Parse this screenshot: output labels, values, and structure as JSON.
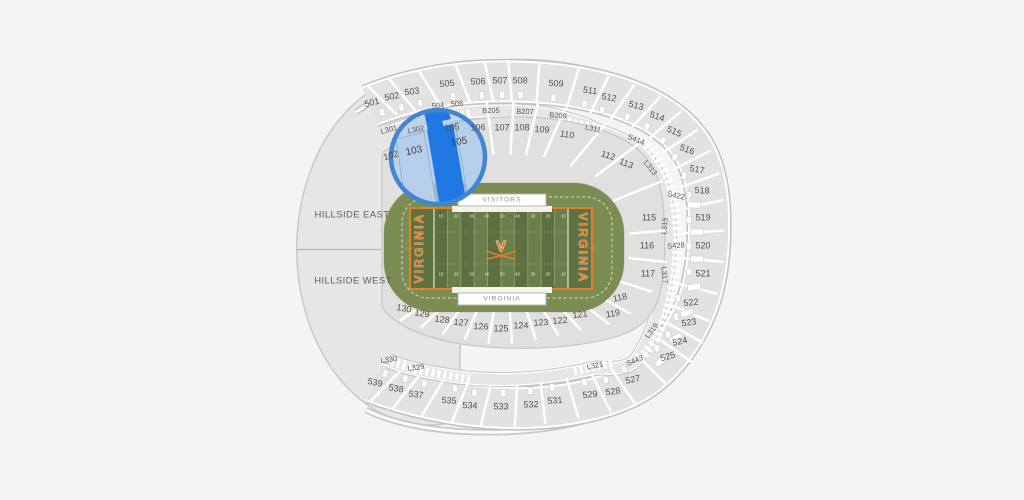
{
  "map": {
    "colors": {
      "background": "#f5f4f2",
      "section_fill": "#e3e2e0",
      "field_green": "#6b7f4a",
      "apron_green": "#7b8d52",
      "team_orange": "#e87f2a",
      "selected_section_blue": "#2079e2",
      "lens_ring_blue": "#4285d2",
      "lens_tint_blue": "#adcbed"
    },
    "lens": {
      "magnified_section_labels": [
        "103",
        "105"
      ],
      "selected_fill": "#2079e2",
      "ring_color": "#4285d2"
    },
    "field": {
      "yard_numbers": [
        "10",
        "20",
        "30",
        "40",
        "50",
        "40",
        "30",
        "20",
        "10"
      ]
    },
    "labels": [
      {
        "t": "501",
        "x": 372,
        "y": 103,
        "r": -14,
        "c": "sec"
      },
      {
        "t": "502",
        "x": 392,
        "y": 97,
        "r": -11,
        "c": "sec"
      },
      {
        "t": "503",
        "x": 412,
        "y": 92,
        "r": -8,
        "c": "sec"
      },
      {
        "t": "505",
        "x": 447,
        "y": 84,
        "r": -5,
        "c": "sec"
      },
      {
        "t": "506",
        "x": 478,
        "y": 82,
        "r": -2,
        "c": "sec"
      },
      {
        "t": "507",
        "x": 500,
        "y": 81,
        "r": 0,
        "c": "sec"
      },
      {
        "t": "508",
        "x": 520,
        "y": 81,
        "r": 1,
        "c": "sec"
      },
      {
        "t": "509",
        "x": 556,
        "y": 84,
        "r": 4,
        "c": "sec"
      },
      {
        "t": "511",
        "x": 590,
        "y": 91,
        "r": 8,
        "c": "sec"
      },
      {
        "t": "512",
        "x": 609,
        "y": 98,
        "r": 10,
        "c": "sec"
      },
      {
        "t": "513",
        "x": 636,
        "y": 106,
        "r": 14,
        "c": "sec"
      },
      {
        "t": "514",
        "x": 657,
        "y": 117,
        "r": 19,
        "c": "sec"
      },
      {
        "t": "515",
        "x": 674,
        "y": 132,
        "r": 24,
        "c": "sec"
      },
      {
        "t": "516",
        "x": 687,
        "y": 150,
        "r": 20,
        "c": "sec"
      },
      {
        "t": "517",
        "x": 697,
        "y": 170,
        "r": 10,
        "c": "sec"
      },
      {
        "t": "518",
        "x": 702,
        "y": 191,
        "r": 4,
        "c": "sec"
      },
      {
        "t": "519",
        "x": 703,
        "y": 218,
        "r": 0,
        "c": "sec"
      },
      {
        "t": "520",
        "x": 703,
        "y": 246,
        "r": 0,
        "c": "sec"
      },
      {
        "t": "521",
        "x": 703,
        "y": 274,
        "r": 0,
        "c": "sec"
      },
      {
        "t": "522",
        "x": 691,
        "y": 303,
        "r": -6,
        "c": "sec"
      },
      {
        "t": "523",
        "x": 689,
        "y": 323,
        "r": -8,
        "c": "sec"
      },
      {
        "t": "524",
        "x": 680,
        "y": 342,
        "r": -12,
        "c": "sec"
      },
      {
        "t": "525",
        "x": 668,
        "y": 357,
        "r": -16,
        "c": "sec"
      },
      {
        "t": "527",
        "x": 633,
        "y": 380,
        "r": -12,
        "c": "sec"
      },
      {
        "t": "528",
        "x": 613,
        "y": 392,
        "r": -8,
        "c": "sec"
      },
      {
        "t": "529",
        "x": 590,
        "y": 395,
        "r": -6,
        "c": "sec"
      },
      {
        "t": "531",
        "x": 555,
        "y": 401,
        "r": -4,
        "c": "sec"
      },
      {
        "t": "532",
        "x": 531,
        "y": 405,
        "r": -2,
        "c": "sec"
      },
      {
        "t": "533",
        "x": 501,
        "y": 407,
        "r": 0,
        "c": "sec"
      },
      {
        "t": "534",
        "x": 470,
        "y": 406,
        "r": 2,
        "c": "sec"
      },
      {
        "t": "535",
        "x": 449,
        "y": 401,
        "r": 4,
        "c": "sec"
      },
      {
        "t": "537",
        "x": 416,
        "y": 395,
        "r": 7,
        "c": "sec"
      },
      {
        "t": "538",
        "x": 396,
        "y": 389,
        "r": 9,
        "c": "sec"
      },
      {
        "t": "539",
        "x": 375,
        "y": 383,
        "r": 12,
        "c": "sec"
      },
      {
        "t": "102",
        "x": 391,
        "y": 156,
        "r": -16,
        "c": "sec"
      },
      {
        "t": "106",
        "x": 478,
        "y": 128,
        "r": -3,
        "c": "sec"
      },
      {
        "t": "107",
        "x": 502,
        "y": 128,
        "r": 0,
        "c": "sec"
      },
      {
        "t": "108",
        "x": 522,
        "y": 128,
        "r": 0,
        "c": "sec"
      },
      {
        "t": "109",
        "x": 542,
        "y": 130,
        "r": 3,
        "c": "sec"
      },
      {
        "t": "110",
        "x": 567,
        "y": 135,
        "r": 8,
        "c": "sec"
      },
      {
        "t": "112",
        "x": 608,
        "y": 156,
        "r": 18,
        "c": "sec"
      },
      {
        "t": "113",
        "x": 626,
        "y": 164,
        "r": 22,
        "c": "sec"
      },
      {
        "t": "115",
        "x": 649,
        "y": 218,
        "r": 0,
        "c": "sec"
      },
      {
        "t": "116",
        "x": 647,
        "y": 246,
        "r": 0,
        "c": "sec"
      },
      {
        "t": "117",
        "x": 648,
        "y": 274,
        "r": 0,
        "c": "sec"
      },
      {
        "t": "118",
        "x": 620,
        "y": 298,
        "r": -12,
        "c": "sec"
      },
      {
        "t": "119",
        "x": 613,
        "y": 314,
        "r": -10,
        "c": "sec"
      },
      {
        "t": "121",
        "x": 580,
        "y": 315,
        "r": -7,
        "c": "sec"
      },
      {
        "t": "122",
        "x": 560,
        "y": 321,
        "r": -5,
        "c": "sec"
      },
      {
        "t": "123",
        "x": 541,
        "y": 323,
        "r": -3,
        "c": "sec"
      },
      {
        "t": "124",
        "x": 521,
        "y": 326,
        "r": -1,
        "c": "sec"
      },
      {
        "t": "125",
        "x": 501,
        "y": 329,
        "r": 0,
        "c": "sec"
      },
      {
        "t": "126",
        "x": 481,
        "y": 327,
        "r": 2,
        "c": "sec"
      },
      {
        "t": "127",
        "x": 461,
        "y": 323,
        "r": 4,
        "c": "sec"
      },
      {
        "t": "128",
        "x": 442,
        "y": 320,
        "r": 6,
        "c": "sec"
      },
      {
        "t": "129",
        "x": 422,
        "y": 314,
        "r": 8,
        "c": "sec"
      },
      {
        "t": "130",
        "x": 404,
        "y": 309,
        "r": 10,
        "c": "sec"
      },
      {
        "t": "L301",
        "x": 389,
        "y": 130,
        "r": -14,
        "c": "loge"
      },
      {
        "t": "L302",
        "x": 416,
        "y": 130,
        "r": -12,
        "c": "loge"
      },
      {
        "t": "B205",
        "x": 491,
        "y": 111,
        "r": -2,
        "c": "loge"
      },
      {
        "t": "B207",
        "x": 525,
        "y": 112,
        "r": 1,
        "c": "loge"
      },
      {
        "t": "B209",
        "x": 558,
        "y": 116,
        "r": 5,
        "c": "loge"
      },
      {
        "t": "L311",
        "x": 593,
        "y": 129,
        "r": 12,
        "c": "loge"
      },
      {
        "t": "S414",
        "x": 636,
        "y": 140,
        "r": 22,
        "c": "loge"
      },
      {
        "t": "L313",
        "x": 650,
        "y": 168,
        "r": 52,
        "c": "loge"
      },
      {
        "t": "S422",
        "x": 676,
        "y": 196,
        "r": 12,
        "c": "loge"
      },
      {
        "t": "L315",
        "x": 665,
        "y": 226,
        "r": -85,
        "c": "loge"
      },
      {
        "t": "S428",
        "x": 676,
        "y": 246,
        "r": -5,
        "c": "loge"
      },
      {
        "t": "L317",
        "x": 664,
        "y": 275,
        "r": 85,
        "c": "loge"
      },
      {
        "t": "L319",
        "x": 652,
        "y": 331,
        "r": -52,
        "c": "loge"
      },
      {
        "t": "S443",
        "x": 635,
        "y": 361,
        "r": -22,
        "c": "loge"
      },
      {
        "t": "L321",
        "x": 595,
        "y": 366,
        "r": -12,
        "c": "loge"
      },
      {
        "t": "L329",
        "x": 416,
        "y": 368,
        "r": -8,
        "c": "loge"
      },
      {
        "t": "L330",
        "x": 389,
        "y": 360,
        "r": -10,
        "c": "loge"
      },
      {
        "t": "504",
        "x": 438,
        "y": 106,
        "r": -5,
        "c": "loge"
      },
      {
        "t": "506",
        "x": 457,
        "y": 104,
        "r": -3,
        "c": "loge"
      },
      {
        "t": "105",
        "x": 452,
        "y": 128,
        "r": -8,
        "c": "sec"
      },
      {
        "t": "103",
        "x": 414,
        "y": 151,
        "r": -12,
        "c": "lens"
      },
      {
        "t": "105",
        "x": 459,
        "y": 142,
        "r": -10,
        "c": "lens"
      },
      {
        "t": "HILLSIDE EAST",
        "x": 352,
        "y": 215,
        "r": 0,
        "c": "hill"
      },
      {
        "t": "HILLSIDE WEST",
        "x": 353,
        "y": 281,
        "r": 0,
        "c": "hill"
      },
      {
        "t": "VISITORS",
        "x": 502,
        "y": 200,
        "r": 0,
        "c": "box"
      },
      {
        "t": "VIRGINIA",
        "x": 502,
        "y": 299,
        "r": 0,
        "c": "box"
      },
      {
        "t": "VIRGINIA",
        "x": 420,
        "y": 248,
        "r": -90,
        "c": "ez"
      },
      {
        "t": "VIRGINIA",
        "x": 582,
        "y": 248,
        "r": 90,
        "c": "ez"
      },
      {
        "t": "V",
        "x": 501,
        "y": 247,
        "r": 0,
        "c": "logo"
      }
    ]
  }
}
